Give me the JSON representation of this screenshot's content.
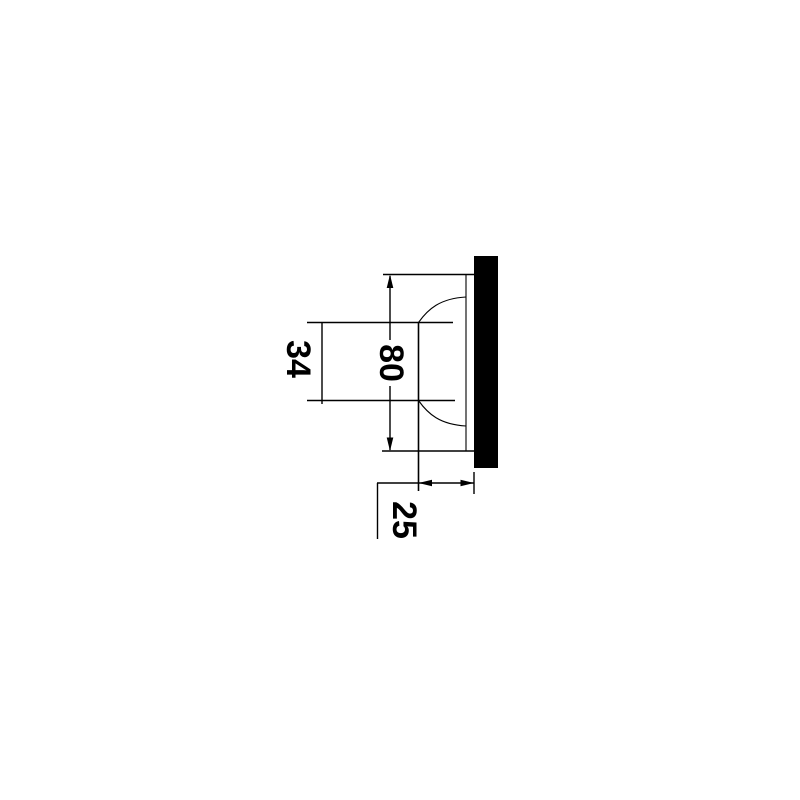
{
  "page": {
    "background_color": "#ffffff",
    "ink_color": "#000000"
  },
  "drawing": {
    "kind": "technical-dimension-drawing",
    "subject": "recessed-fixture-side-profile-on-panel",
    "units_shown": false,
    "dimensions": {
      "overall_height": {
        "label": "80",
        "orientation": "vertical",
        "text_rotation_deg": 90
      },
      "opening_height": {
        "label": "34",
        "orientation": "vertical",
        "text_rotation_deg": 90
      },
      "protrusion_depth": {
        "label": "25",
        "orientation": "horizontal",
        "text_rotation_deg": 90
      }
    }
  }
}
